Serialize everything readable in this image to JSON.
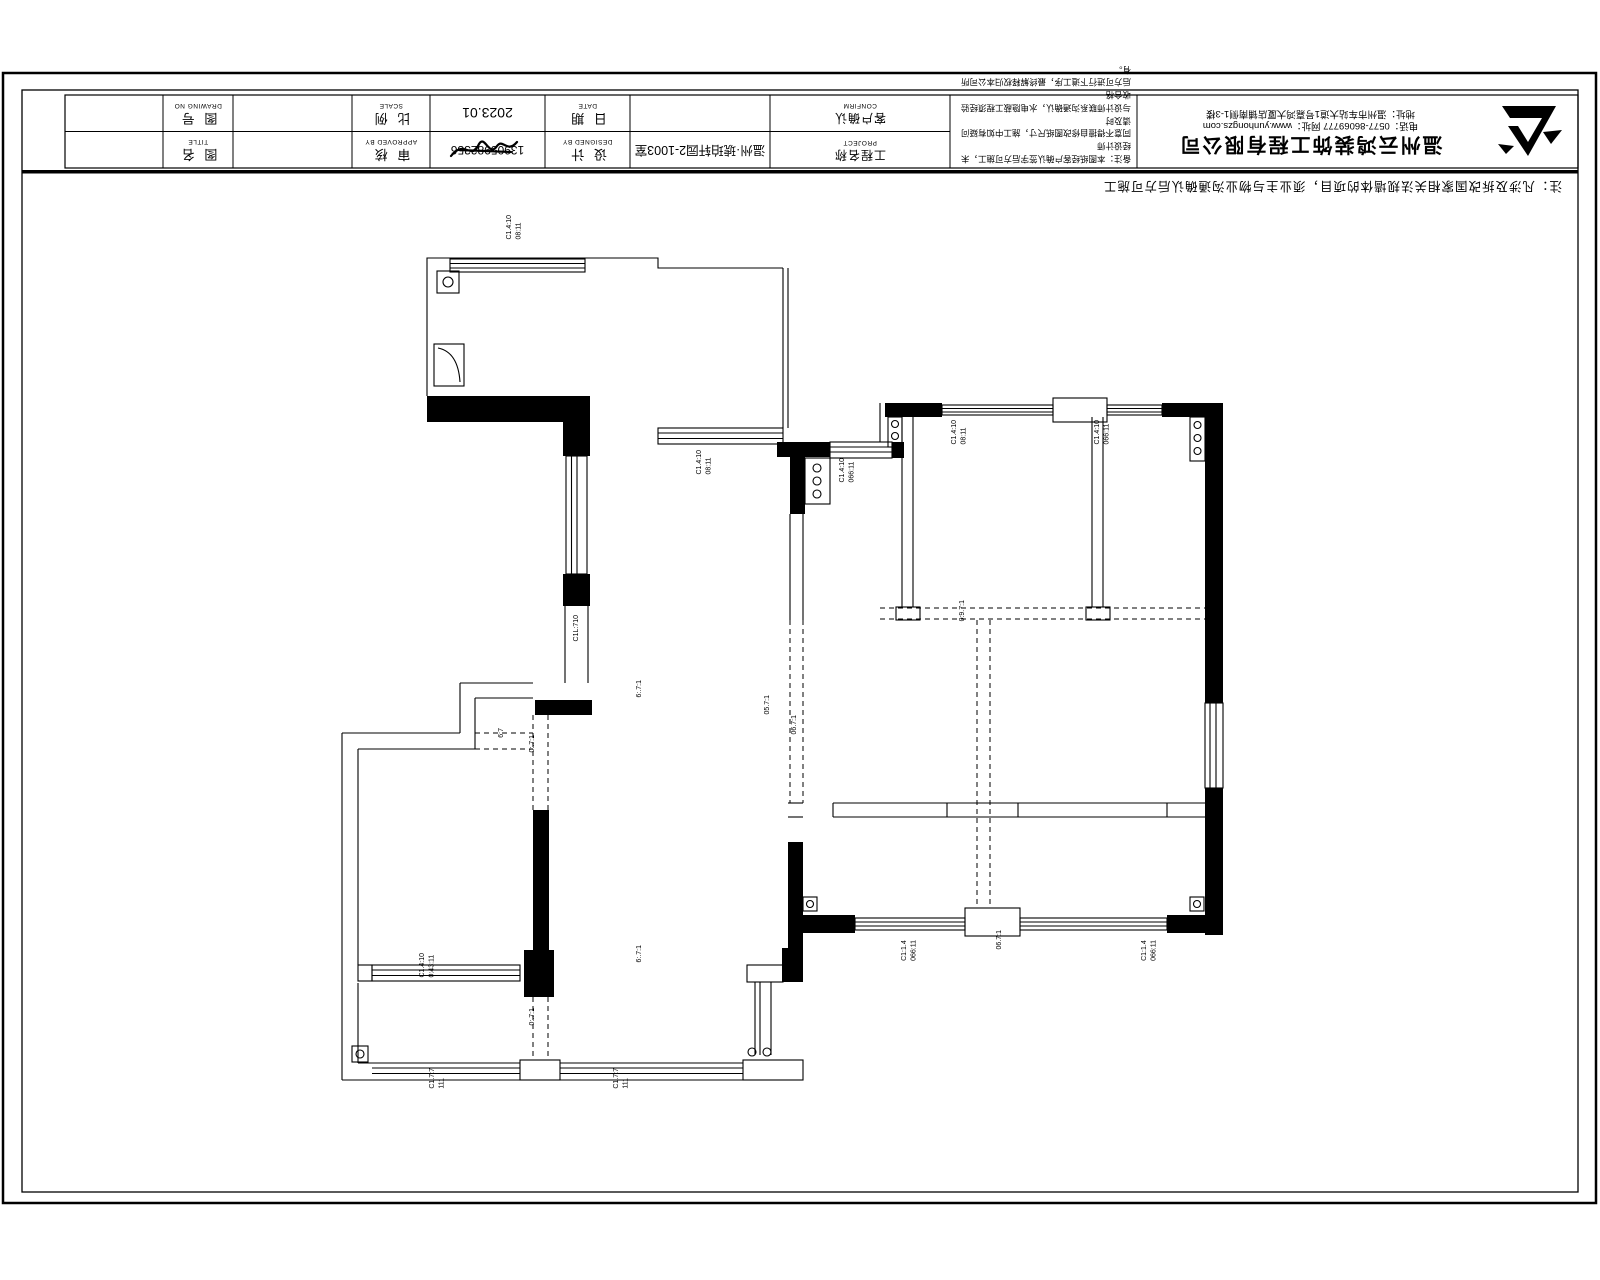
{
  "sheet": {
    "note_line": "注：凡涉及拆改国家相关法规墙体的项目，须业主与物业沟通确认后方可施工",
    "title_block": {
      "drawing_no": {
        "zh": "图  号",
        "en": "DRAWING NO"
      },
      "title_lbl": {
        "zh": "图  名",
        "en": "TITLE"
      },
      "scale": {
        "zh": "比  例",
        "en": "SCALE"
      },
      "approved": {
        "zh": "审  核",
        "en": "APPROVED BY"
      },
      "date_lbl": {
        "zh": "日  期",
        "en": "DATE"
      },
      "designed": {
        "zh": "设  计",
        "en": "DESIGNED BY"
      },
      "confirm": {
        "zh": "客户确认",
        "en": "CONFIRM"
      },
      "project": {
        "zh": "工程名称",
        "en": "PROJECT"
      },
      "date_value": "2023.01",
      "designer_value": "13905982356",
      "project_value": "温州·琥珀轩园2-1003室",
      "notes": [
        "备注：本图纸经客户确认签字后方可施工，未经设计师",
        "同意不得擅自修改图纸尺寸，施工中如有疑问请及时",
        "与设计师联系沟通确认，水电隐蔽工程须经验收合格",
        "后方可进行下道工序，最终解释权归本公司所有。"
      ],
      "company": {
        "name": "温州云鸿装饰工程有限公司",
        "contact": "电话：0577-86069777 网址：www.yunhongzs.com",
        "address": "地址：温州市车站大道1号嘉鸿大厦店铺南侧1-3楼"
      }
    },
    "plan_labels": [
      {
        "x": 505,
        "y": 215,
        "text": "C1.4:10\n08:11"
      },
      {
        "x": 695,
        "y": 450,
        "text": "C1.4:10\n08:11"
      },
      {
        "x": 838,
        "y": 458,
        "text": "C1.4:10\n066:11"
      },
      {
        "x": 950,
        "y": 420,
        "text": "C1.4:10\n08:11"
      },
      {
        "x": 1093,
        "y": 420,
        "text": "C1.4:10\n066:11"
      },
      {
        "x": 572,
        "y": 615,
        "text": "C1L:710"
      },
      {
        "x": 528,
        "y": 735,
        "text": "0:.7:1"
      },
      {
        "x": 497,
        "y": 728,
        "text": "6:7"
      },
      {
        "x": 635,
        "y": 680,
        "text": "6:.7:1"
      },
      {
        "x": 763,
        "y": 695,
        "text": "05.7:1"
      },
      {
        "x": 790,
        "y": 715,
        "text": "06.7:1"
      },
      {
        "x": 958,
        "y": 600,
        "text": "0:9.7:1"
      },
      {
        "x": 995,
        "y": 930,
        "text": "06.7:1"
      },
      {
        "x": 635,
        "y": 945,
        "text": "6:.7:1"
      },
      {
        "x": 528,
        "y": 1008,
        "text": "0:.7:1"
      },
      {
        "x": 900,
        "y": 940,
        "text": "C1:1.4\n066:11"
      },
      {
        "x": 1140,
        "y": 940,
        "text": "C1:1.4\n066:11"
      },
      {
        "x": 418,
        "y": 953,
        "text": "C1.4:10\n0:43:11"
      },
      {
        "x": 428,
        "y": 1068,
        "text": "C1.7:7\n111"
      },
      {
        "x": 612,
        "y": 1068,
        "text": "C1.7:7\n111"
      }
    ]
  }
}
